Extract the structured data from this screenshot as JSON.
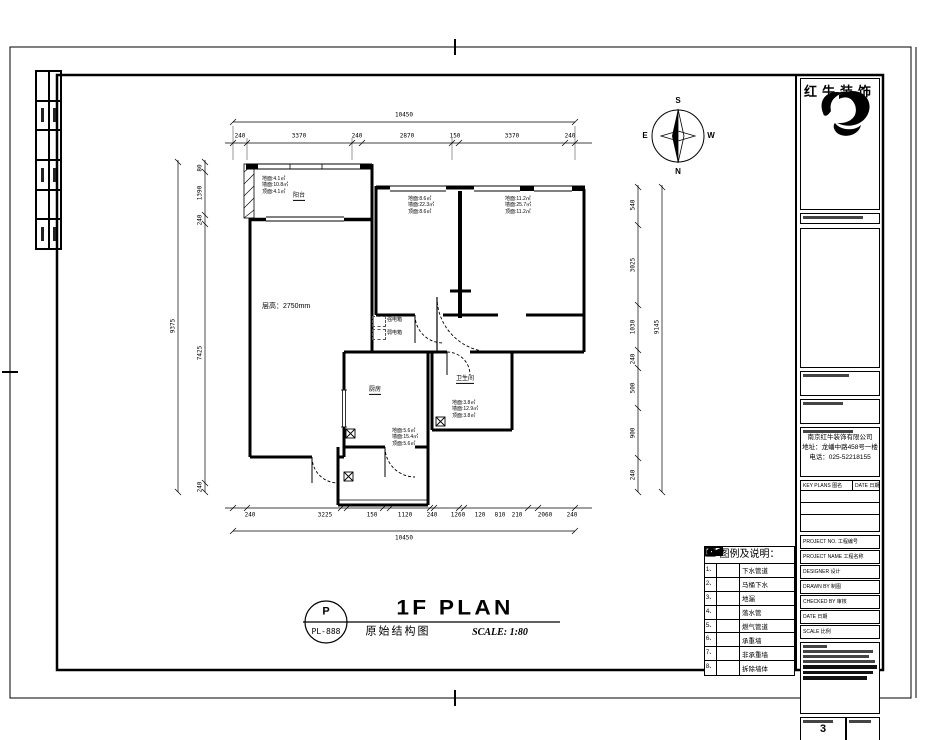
{
  "sheet": {
    "logo_text": "红牛装饰",
    "company": {
      "name": "南京红牛装饰有限公司",
      "address": "地址：龙蟠中路458号一楼",
      "phone": "电话：025-52218155"
    },
    "drawing_no": "3",
    "compass": {
      "n": "N",
      "s": "S",
      "e": "E",
      "w": "W"
    }
  },
  "stamp": {
    "letter": "P",
    "code": "PL-888",
    "drawing_name_cn": "原始结构图",
    "title": "1F PLAN",
    "scale": "SCALE: 1:80"
  },
  "titleblock": {
    "keyplan_left": "KEY PLANS 图名",
    "keyplan_right": "DATE 日期",
    "rows": [
      {
        "label": "PROJECT NO. 工程编号"
      },
      {
        "label": "PROJECT NAME 工程名称"
      },
      {
        "label": "DESIGNER 设计"
      },
      {
        "label": "DRAWN BY 制图"
      },
      {
        "label": "CHECKED BY 审核"
      },
      {
        "label": "DATE 日期"
      },
      {
        "label": "SCALE 比例"
      }
    ]
  },
  "legend": {
    "title": "图例及说明：",
    "rows": [
      {
        "num": "1、",
        "label": "下水管道"
      },
      {
        "num": "2、",
        "label": "马桶下水"
      },
      {
        "num": "3、",
        "label": "地漏"
      },
      {
        "num": "4、",
        "label": "落水管"
      },
      {
        "num": "5、",
        "label": "燃气管道"
      },
      {
        "num": "6、",
        "label": "承重墙"
      },
      {
        "num": "7、",
        "label": "非承重墙"
      },
      {
        "num": "8、",
        "label": "拆除墙体"
      }
    ]
  },
  "plan": {
    "ceiling_height": "层高：2750mm",
    "rooms": {
      "balcony": "阳台",
      "kitchen": "厨房",
      "bath": "卫生间"
    },
    "annotations": {
      "balcony": "地面:4.1㎡\n墙面:10.8㎡\n顶面:4.1㎡",
      "bedroomA": "地面:8.6㎡\n墙面:22.3㎡\n顶面:8.6㎡",
      "bedroomB": "地面:11.2㎡\n墙面:25.7㎡\n顶面:11.2㎡",
      "kitchen": "地面:5.6㎡\n墙面:15.4㎡\n顶面:5.6㎡",
      "bath": "地面:3.8㎡\n墙面:12.9㎡\n顶面:3.8㎡"
    },
    "elec": {
      "strong": "强电箱",
      "weak": "弱电箱"
    }
  },
  "dims": {
    "top_total": "10450",
    "top": [
      "240",
      "3370",
      "240",
      "2870",
      "150",
      "3370",
      "240"
    ],
    "bottom": [
      "240",
      "3225",
      "150",
      "1120",
      "240",
      "1260",
      "120",
      "810",
      "210",
      "2060",
      "240"
    ],
    "bottom_total": "10450",
    "left": [
      "80",
      "1390",
      "240",
      "7425",
      "240"
    ],
    "left_total": "9375",
    "right": [
      "540",
      "3025",
      "1030",
      "240",
      "500",
      "900",
      "240"
    ],
    "right_total": "9145"
  }
}
